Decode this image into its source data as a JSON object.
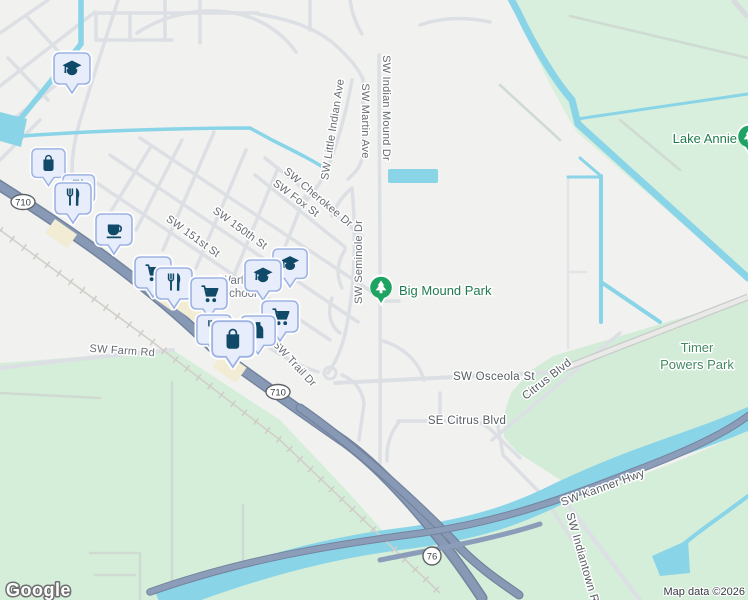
{
  "map": {
    "attribution": "Map data ©2026",
    "logo_text": "Google",
    "street_labels": {
      "indian_mound": "SW Indian Mound Dr",
      "martin": "SW Martin Ave",
      "little_indian": "SW Little Indian Ave",
      "cherokee": "SW Cherokee Dr",
      "fox": "SW Fox St",
      "st151": "SW 151st St",
      "st150": "SW 150th St",
      "seminole": "SW Seminole Dr",
      "trail": "SW Trail Dr",
      "farm": "SW Farm Rd",
      "osceola": "SW Osceola St",
      "citrus": "Citrus Blvd",
      "se_citrus": "SE Citrus Blvd",
      "kanner": "SW Kanner Hwy",
      "indiantown": "SW Indiantown Rd"
    },
    "park_labels": {
      "lake_annie": "Lake Annie",
      "big_mound": "Big Mound Park",
      "timer_line1": "Timer",
      "timer_line2": "Powers Park"
    },
    "poi_labels": {
      "school_line1": "Warfield",
      "school_line2": "School"
    },
    "shields": {
      "route710": "710",
      "route76": "76"
    },
    "poi_markers": [
      {
        "icon": "graduation-cap-icon"
      },
      {
        "icon": "shopping-bag-icon"
      },
      {
        "icon": "restaurant-icon"
      },
      {
        "icon": "coffee-cup-icon"
      },
      {
        "icon": "shopping-cart-icon"
      },
      {
        "icon": "bottle-icon"
      },
      {
        "icon": "park-tree-icon"
      }
    ],
    "colors": {
      "background": "#f1f1ef",
      "park_green": "#d7efdc",
      "water": "#8ad4e8",
      "road_major": "#8799b4",
      "marker_fill": "#e7edfb",
      "marker_border": "#9db3e3",
      "marker_icon": "#114a68",
      "park_pin_green": "#1ea362",
      "park_label_green": "#1f7b4d",
      "street_label_gray": "#666b72"
    }
  }
}
